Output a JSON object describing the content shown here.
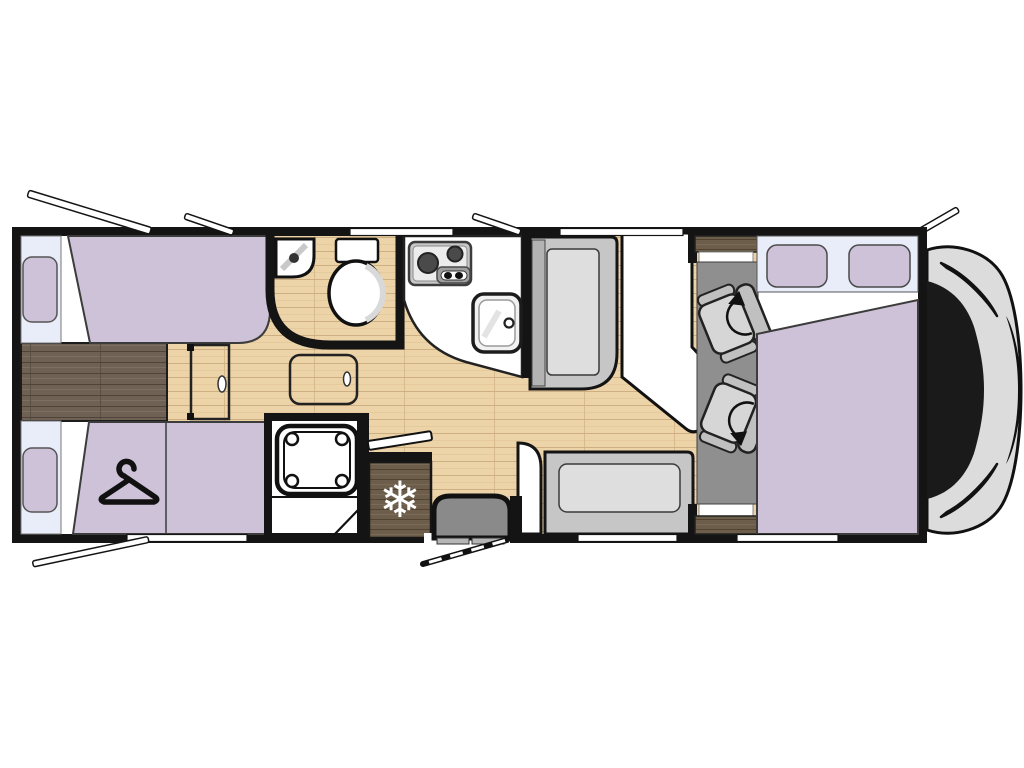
{
  "diagram": {
    "kind": "motorhome-floor-plan",
    "view": "top-down",
    "rooms": [
      "rear-twin-bedroom",
      "washroom",
      "shower",
      "kitchen",
      "dinette",
      "cab",
      "overcab-bed"
    ],
    "furniture": [
      "twin-bed-left-upper",
      "twin-bed-left-lower",
      "wardrobe-hanger",
      "corner-washbasin",
      "toilet",
      "shower-tray",
      "two-burner-hob",
      "kitchen-sink",
      "refrigerator",
      "entry-step",
      "dinette-bench-side",
      "dinette-bench-rear",
      "dinette-table",
      "swivel-cab-seat-front",
      "swivel-cab-seat-rear",
      "double-bed-overcab",
      "vehicle-front-cab"
    ]
  },
  "icons": {
    "snowflake_glyph": "❄"
  },
  "colors": {
    "page_bg": "#ffffff",
    "wall": "#141414",
    "purple": "#cec2d8",
    "blue": "#e8edf9",
    "white": "#ffffff",
    "bench": "#c6c6c6",
    "cushion": "#dedede",
    "cab_floor": "#8f8f8f",
    "seat": "#d6d6d6",
    "seat_frame": "#c0c0c0",
    "step": "#8a8a8a",
    "nose": "#dcdcdc",
    "glass": "#1a1a1a"
  }
}
